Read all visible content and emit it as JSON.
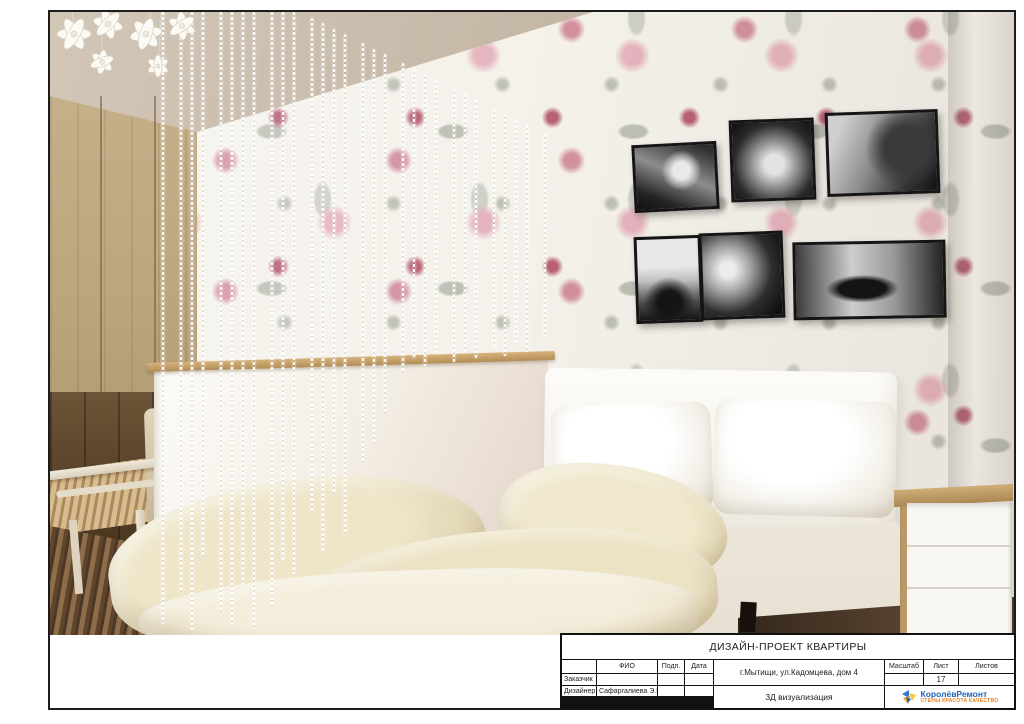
{
  "colors": {
    "frame_border": "#1c1c1c",
    "logo_blue": "#1e63b4",
    "logo_orange": "#ed7d1c",
    "wallpaper_pink": "#c56a80",
    "wood": "#b49a72"
  },
  "title_block": {
    "title": "ДИЗАЙН-ПРОЕКТ КВАРТИРЫ",
    "col_headers": {
      "fio": "ФИО",
      "sign": "Подп.",
      "date": "Дата",
      "scale": "Масштаб",
      "sheet": "Лист",
      "sheets": "Листов"
    },
    "address": "г.Мытищи, ул.Кадомцева, дом 4",
    "rows": [
      {
        "label": "Заказчик",
        "fio": ""
      },
      {
        "label": "Дизайнер",
        "fio": "Сафаргалиева Э.Г."
      },
      {
        "label": "Исполнил",
        "fio": "Чарух.Р.И."
      }
    ],
    "scale_value": "",
    "sheet_number": "17",
    "sheets_value": "",
    "drawing_name": "3Д визуализация",
    "logo": {
      "name": "КоролёвРемонт",
      "tagline": "СТЕНЫ КРАСОТА КАЧЕСТВО"
    }
  },
  "scene": {
    "photo_names": [
      "palm-trees",
      "surfer-in-wave",
      "surfboard-beach",
      "yoga-on-rock",
      "wave-curl",
      "lying-figure"
    ]
  }
}
